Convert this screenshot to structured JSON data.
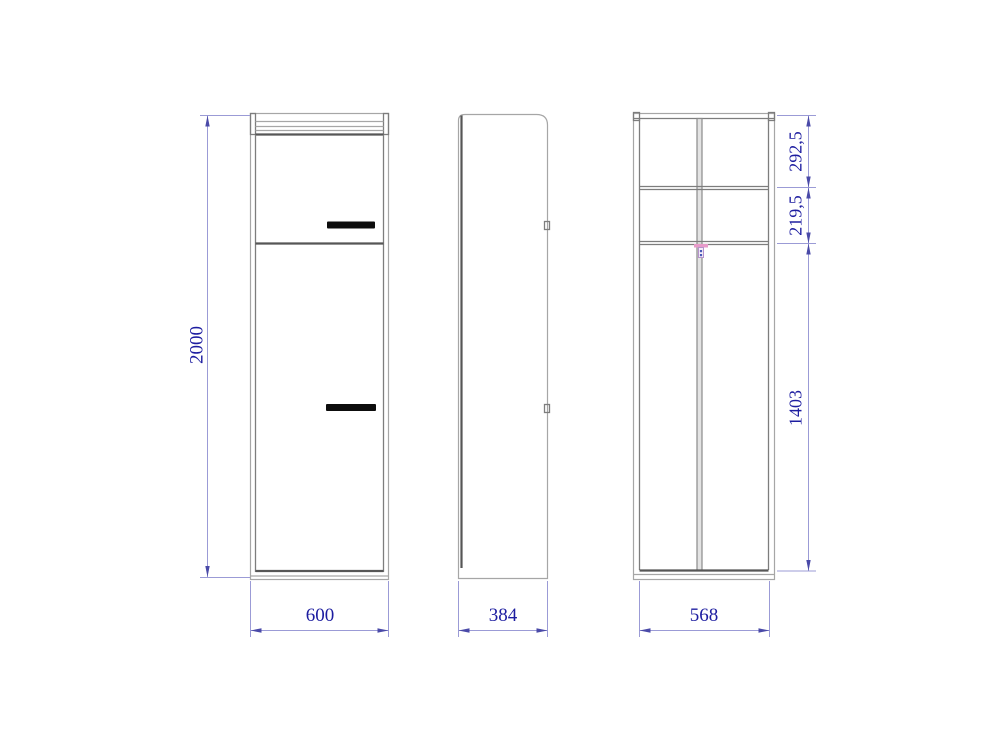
{
  "drawing": {
    "type": "furniture technical drawing, three orthographic views of a wardrobe cabinet",
    "background": "#ffffff"
  },
  "dims": {
    "front_height": "2000",
    "front_width": "600",
    "side_depth": "384",
    "interior_width": "568",
    "interior_top_section": "292,5",
    "interior_middle_section": "219,5",
    "interior_bottom_section": "1403"
  },
  "colors": {
    "outline_light": "#a6a6a6",
    "outline_medium": "#7d7d7d",
    "outline_dark": "#565656",
    "dimension_line": "#9b9bd6",
    "dimension_arrow": "#4a4aa8",
    "dimension_text": "#1d1da0",
    "door_handle": "#0d0d0d",
    "rail_bracket": "#e79bc9"
  }
}
